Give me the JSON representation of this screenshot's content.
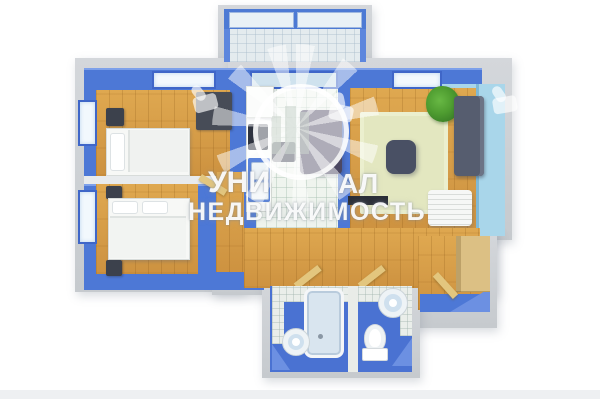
{
  "watermark": {
    "line1_left": "УНИ",
    "line1_right": "АЛ",
    "line2": "НЕДВИЖИМОСТЬ",
    "logo": "city-skyline-sunburst-badge",
    "side_icon": "thumbs-up"
  },
  "floorplan": {
    "type": "3d-top-down-apartment-floor-plan",
    "rooms": [
      {
        "name": "balcony",
        "floor": "light-tile",
        "features": [
          "glazed-window-band"
        ]
      },
      {
        "name": "bedroom-1",
        "floor": "wood",
        "wall_color_key": "wall_blue",
        "furniture": [
          "single-bed",
          "pillow",
          "nightstand",
          "wardrobe"
        ],
        "windows": 2
      },
      {
        "name": "bedroom-2",
        "floor": "wood",
        "wall_color_key": "wall_blue",
        "furniture": [
          "double-bed",
          "pillows",
          "nightstand",
          "nightstand"
        ],
        "windows": 1
      },
      {
        "name": "kitchen",
        "floor": "tile",
        "wall_color_key": "wall_blue",
        "furniture": [
          "fridge",
          "counter",
          "cooktop",
          "double-sink",
          "dining-table",
          "stool"
        ],
        "windows": 1
      },
      {
        "name": "living-room",
        "floor": "wood",
        "wall_color_key": "wall_light_blue",
        "furniture": [
          "sofa",
          "rug",
          "coffee-table",
          "tv-bench",
          "plant",
          "slatted-bench"
        ],
        "windows": 1
      },
      {
        "name": "hallway-entry",
        "floor": "wood",
        "furniture": [
          "wardrobe",
          "open-door",
          "open-door",
          "open-door",
          "entry-step"
        ]
      },
      {
        "name": "bathroom",
        "floor": "blue",
        "furniture": [
          "bathtub",
          "round-sink",
          "step-platform"
        ]
      },
      {
        "name": "toilet-room",
        "floor": "blue",
        "furniture": [
          "toilet",
          "round-sink",
          "corner-ledge"
        ]
      }
    ],
    "colors": {
      "wall_blue": "#4d78d6",
      "wall_light_blue": "#a9d6ea",
      "wall_gray": "#c7cbd0",
      "floor_wood": "#d7a14c",
      "floor_tile": "#eff4ee",
      "floor_bath_blue": "#4a72d2",
      "rug": "#e3e7c0",
      "background": "#ffffff"
    }
  }
}
